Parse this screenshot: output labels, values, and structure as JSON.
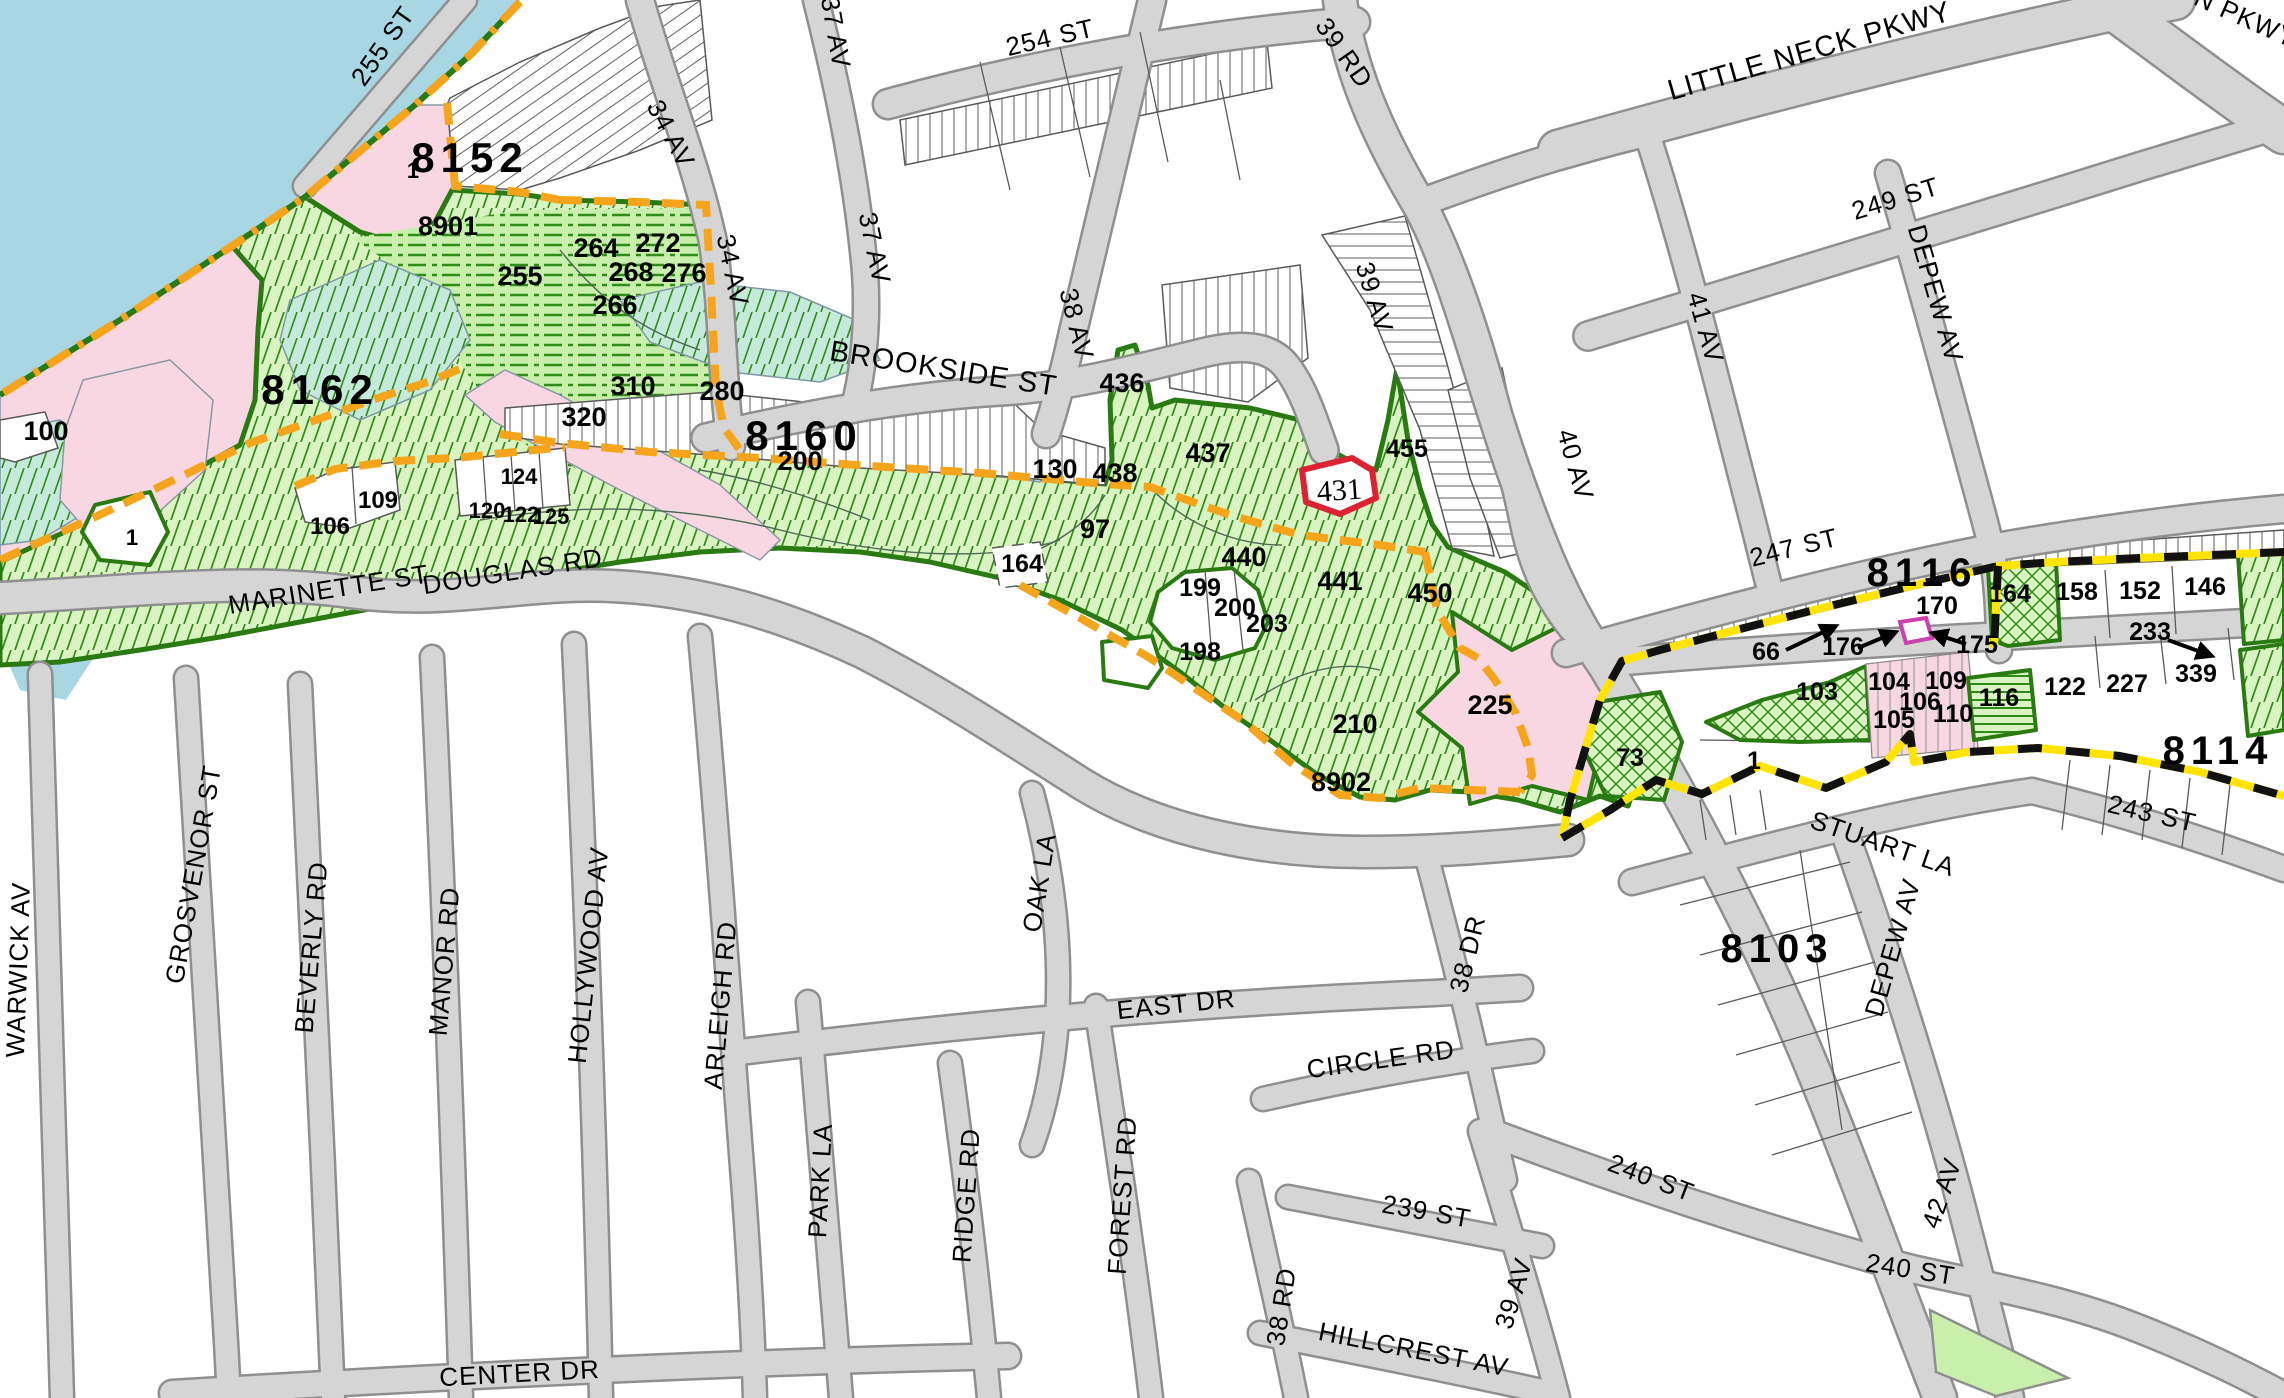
{
  "map": {
    "area": "Douglaston / Little Neck parcel map"
  },
  "colors": {
    "water": "#a9d6e3",
    "pink": "#f9d7e2",
    "park": "#d9f3c2",
    "parkLine": "#2f8c17",
    "parkEdge": "#2a7a12",
    "dashBg": "#c9efad",
    "tealBg": "#c5e9da",
    "orange": "#f6a41c",
    "boundYellow": "#ffe400",
    "red": "#dd2233",
    "magenta": "#cc3fae",
    "roadFill": "#d5d5d5",
    "roadCase": "#8f8f8f"
  },
  "labels": {
    "blocks": [
      {
        "text": "8152",
        "x": 470,
        "y": 172,
        "rot": 0,
        "size": 42
      },
      {
        "text": "8162",
        "x": 320,
        "y": 404,
        "rot": 0,
        "size": 42
      },
      {
        "text": "8160",
        "x": 804,
        "y": 450,
        "rot": 0,
        "size": 42
      },
      {
        "text": "8116",
        "x": 1922,
        "y": 586,
        "rot": 0,
        "size": 40
      },
      {
        "text": "8114",
        "x": 2218,
        "y": 764,
        "rot": 0,
        "size": 40
      },
      {
        "text": "8103",
        "x": 1777,
        "y": 962,
        "rot": 0,
        "size": 40
      }
    ],
    "streets": [
      {
        "text": "255 ST",
        "x": 390,
        "y": 51,
        "rot": -55,
        "size": 26
      },
      {
        "text": "34 AV",
        "x": 663,
        "y": 138,
        "rot": 62,
        "size": 26
      },
      {
        "text": "37 AV",
        "x": 827,
        "y": 34,
        "rot": 80,
        "size": 26
      },
      {
        "text": "254 ST",
        "x": 1052,
        "y": 46,
        "rot": -13,
        "size": 26
      },
      {
        "text": "39 RD",
        "x": 1337,
        "y": 58,
        "rot": 55,
        "size": 26
      },
      {
        "text": "34 AV",
        "x": 724,
        "y": 272,
        "rot": 78,
        "size": 26
      },
      {
        "text": "37 AV",
        "x": 866,
        "y": 250,
        "rot": 78,
        "size": 26
      },
      {
        "text": "38 AV",
        "x": 1068,
        "y": 326,
        "rot": 76,
        "size": 26
      },
      {
        "text": "BROOKSIDE ST",
        "x": 942,
        "y": 378,
        "rot": 9,
        "size": 29
      },
      {
        "text": "39 AV",
        "x": 1366,
        "y": 300,
        "rot": 73,
        "size": 26
      },
      {
        "text": "40 AV",
        "x": 1567,
        "y": 467,
        "rot": 74,
        "size": 26
      },
      {
        "text": "41 AV",
        "x": 1697,
        "y": 330,
        "rot": 74,
        "size": 26
      },
      {
        "text": "LITTLE NECK PKWY",
        "x": 1812,
        "y": 60,
        "rot": -16,
        "size": 29
      },
      {
        "text": "N PKWY",
        "x": 2242,
        "y": 26,
        "rot": 24,
        "size": 26
      },
      {
        "text": "249 ST",
        "x": 1898,
        "y": 207,
        "rot": -17,
        "size": 26
      },
      {
        "text": "DEPEW AV",
        "x": 1927,
        "y": 296,
        "rot": 74,
        "size": 26
      },
      {
        "text": "247 ST",
        "x": 1796,
        "y": 556,
        "rot": -14,
        "size": 26
      },
      {
        "text": "MARINETTE ST",
        "x": 330,
        "y": 598,
        "rot": -9,
        "size": 26
      },
      {
        "text": "DOUGLAS RD",
        "x": 514,
        "y": 580,
        "rot": -9,
        "size": 26
      },
      {
        "text": "STUART LA",
        "x": 1880,
        "y": 852,
        "rot": 19,
        "size": 26
      },
      {
        "text": "243 ST",
        "x": 2150,
        "y": 822,
        "rot": 13,
        "size": 26
      },
      {
        "text": "DEPEW AV",
        "x": 1901,
        "y": 950,
        "rot": -74,
        "size": 26
      },
      {
        "text": "WARWICK AV",
        "x": 27,
        "y": 970,
        "rot": -88,
        "size": 26
      },
      {
        "text": "GROSVENOR ST",
        "x": 202,
        "y": 876,
        "rot": -80,
        "size": 26
      },
      {
        "text": "BEVERLY RD",
        "x": 320,
        "y": 948,
        "rot": -85,
        "size": 26
      },
      {
        "text": "MANOR RD",
        "x": 453,
        "y": 962,
        "rot": -85,
        "size": 26
      },
      {
        "text": "HOLLYWOOD AV",
        "x": 597,
        "y": 956,
        "rot": -84,
        "size": 26
      },
      {
        "text": "ARLEIGH RD",
        "x": 729,
        "y": 1006,
        "rot": -85,
        "size": 26
      },
      {
        "text": "PARK LA",
        "x": 829,
        "y": 1181,
        "rot": -87,
        "size": 26
      },
      {
        "text": "RIDGE RD",
        "x": 975,
        "y": 1196,
        "rot": -86,
        "size": 26
      },
      {
        "text": "FOREST RD",
        "x": 1131,
        "y": 1196,
        "rot": -86,
        "size": 26
      },
      {
        "text": "OAK LA",
        "x": 1048,
        "y": 884,
        "rot": -81,
        "size": 26
      },
      {
        "text": "EAST DR",
        "x": 1177,
        "y": 1013,
        "rot": -6,
        "size": 26
      },
      {
        "text": "CIRCLE RD",
        "x": 1382,
        "y": 1068,
        "rot": -8,
        "size": 26
      },
      {
        "text": "38 DR",
        "x": 1476,
        "y": 956,
        "rot": -76,
        "size": 26
      },
      {
        "text": "CENTER DR",
        "x": 520,
        "y": 1382,
        "rot": -3,
        "size": 26
      },
      {
        "text": "239 ST",
        "x": 1425,
        "y": 1220,
        "rot": 10,
        "size": 26
      },
      {
        "text": "38 RD",
        "x": 1290,
        "y": 1308,
        "rot": -81,
        "size": 26
      },
      {
        "text": "39 AV",
        "x": 1522,
        "y": 1296,
        "rot": -73,
        "size": 26
      },
      {
        "text": "HILLCREST AV",
        "x": 1412,
        "y": 1358,
        "rot": 11,
        "size": 26
      },
      {
        "text": "240 ST",
        "x": 1648,
        "y": 1186,
        "rot": 21,
        "size": 26
      },
      {
        "text": "240 ST",
        "x": 1909,
        "y": 1278,
        "rot": 9,
        "size": 26
      },
      {
        "text": "42 AV",
        "x": 1950,
        "y": 1196,
        "rot": -71,
        "size": 26
      }
    ],
    "lots": [
      {
        "text": "1",
        "x": 413,
        "y": 178,
        "rot": 0,
        "size": 22
      },
      {
        "text": "8901",
        "x": 448,
        "y": 235,
        "rot": 0,
        "size": 27
      },
      {
        "text": "255",
        "x": 520,
        "y": 285,
        "rot": 0,
        "size": 27
      },
      {
        "text": "264",
        "x": 596,
        "y": 257,
        "rot": 0,
        "size": 27
      },
      {
        "text": "272",
        "x": 658,
        "y": 252,
        "rot": 0,
        "size": 27
      },
      {
        "text": "268",
        "x": 631,
        "y": 281,
        "rot": 0,
        "size": 27
      },
      {
        "text": "276",
        "x": 684,
        "y": 282,
        "rot": 0,
        "size": 27
      },
      {
        "text": "266",
        "x": 615,
        "y": 314,
        "rot": 0,
        "size": 27
      },
      {
        "text": "310",
        "x": 633,
        "y": 395,
        "rot": 0,
        "size": 27
      },
      {
        "text": "320",
        "x": 584,
        "y": 426,
        "rot": 0,
        "size": 27
      },
      {
        "text": "280",
        "x": 722,
        "y": 400,
        "rot": 0,
        "size": 27
      },
      {
        "text": "200",
        "x": 800,
        "y": 470,
        "rot": 0,
        "size": 27
      },
      {
        "text": "100",
        "x": 46,
        "y": 440,
        "rot": 0,
        "size": 27
      },
      {
        "text": "1",
        "x": 132,
        "y": 545,
        "rot": 0,
        "size": 22
      },
      {
        "text": "106",
        "x": 330,
        "y": 534,
        "rot": 0,
        "size": 24
      },
      {
        "text": "109",
        "x": 378,
        "y": 508,
        "rot": 0,
        "size": 24
      },
      {
        "text": "124",
        "x": 519,
        "y": 484,
        "rot": 0,
        "size": 22
      },
      {
        "text": "120",
        "x": 487,
        "y": 518,
        "rot": 0,
        "size": 22
      },
      {
        "text": "122",
        "x": 521,
        "y": 522,
        "rot": 0,
        "size": 22
      },
      {
        "text": "125",
        "x": 551,
        "y": 524,
        "rot": 0,
        "size": 22
      },
      {
        "text": "130",
        "x": 1055,
        "y": 478,
        "rot": 0,
        "size": 27
      },
      {
        "text": "438",
        "x": 1115,
        "y": 482,
        "rot": 0,
        "size": 27
      },
      {
        "text": "436",
        "x": 1122,
        "y": 392,
        "rot": 0,
        "size": 27
      },
      {
        "text": "437",
        "x": 1208,
        "y": 462,
        "rot": 0,
        "size": 27
      },
      {
        "text": "97",
        "x": 1095,
        "y": 538,
        "rot": 0,
        "size": 27
      },
      {
        "text": "164",
        "x": 1022,
        "y": 572,
        "rot": 0,
        "size": 25
      },
      {
        "text": "440",
        "x": 1244,
        "y": 566,
        "rot": 0,
        "size": 27
      },
      {
        "text": "199",
        "x": 1200,
        "y": 596,
        "rot": 0,
        "size": 25
      },
      {
        "text": "200",
        "x": 1235,
        "y": 616,
        "rot": 0,
        "size": 25
      },
      {
        "text": "203",
        "x": 1267,
        "y": 632,
        "rot": 0,
        "size": 25
      },
      {
        "text": "198",
        "x": 1200,
        "y": 660,
        "rot": 0,
        "size": 25
      },
      {
        "text": "441",
        "x": 1340,
        "y": 590,
        "rot": 0,
        "size": 27
      },
      {
        "text": "450",
        "x": 1430,
        "y": 602,
        "rot": 0,
        "size": 27
      },
      {
        "text": "455",
        "x": 1407,
        "y": 457,
        "rot": 0,
        "size": 25
      },
      {
        "text": "210",
        "x": 1355,
        "y": 733,
        "rot": 0,
        "size": 27
      },
      {
        "text": "225",
        "x": 1490,
        "y": 714,
        "rot": 0,
        "size": 27
      },
      {
        "text": "8902",
        "x": 1341,
        "y": 791,
        "rot": 0,
        "size": 27
      },
      {
        "text": "73",
        "x": 1630,
        "y": 766,
        "rot": 0,
        "size": 25
      },
      {
        "text": "1",
        "x": 1754,
        "y": 769,
        "rot": 0,
        "size": 25
      },
      {
        "text": "66",
        "x": 1766,
        "y": 660,
        "rot": 0,
        "size": 25
      },
      {
        "text": "176",
        "x": 1843,
        "y": 655,
        "rot": 0,
        "size": 25
      },
      {
        "text": "175",
        "x": 1977,
        "y": 653,
        "rot": 0,
        "size": 25
      },
      {
        "text": "170",
        "x": 1937,
        "y": 614,
        "rot": 0,
        "size": 25
      },
      {
        "text": "164",
        "x": 2010,
        "y": 602,
        "rot": 0,
        "size": 25
      },
      {
        "text": "158",
        "x": 2077,
        "y": 600,
        "rot": 0,
        "size": 25
      },
      {
        "text": "152",
        "x": 2140,
        "y": 599,
        "rot": 0,
        "size": 25
      },
      {
        "text": "146",
        "x": 2205,
        "y": 595,
        "rot": 0,
        "size": 25
      },
      {
        "text": "233",
        "x": 2150,
        "y": 640,
        "rot": 0,
        "size": 25
      },
      {
        "text": "103",
        "x": 1817,
        "y": 700,
        "rot": 0,
        "size": 25
      },
      {
        "text": "104",
        "x": 1889,
        "y": 690,
        "rot": 0,
        "size": 25
      },
      {
        "text": "109",
        "x": 1946,
        "y": 689,
        "rot": 0,
        "size": 25
      },
      {
        "text": "106",
        "x": 1920,
        "y": 710,
        "rot": 0,
        "size": 25
      },
      {
        "text": "105",
        "x": 1894,
        "y": 728,
        "rot": 0,
        "size": 25
      },
      {
        "text": "110",
        "x": 1953,
        "y": 722,
        "rot": 0,
        "size": 25
      },
      {
        "text": "116",
        "x": 1999,
        "y": 706,
        "rot": 0,
        "size": 25
      },
      {
        "text": "122",
        "x": 2065,
        "y": 695,
        "rot": 0,
        "size": 25
      },
      {
        "text": "227",
        "x": 2127,
        "y": 692,
        "rot": 0,
        "size": 25
      },
      {
        "text": "339",
        "x": 2196,
        "y": 682,
        "rot": 0,
        "size": 25
      }
    ],
    "special": [
      {
        "text": "431",
        "x": 1340,
        "y": 500,
        "rot": -4,
        "size": 30,
        "font": "serif"
      }
    ]
  }
}
